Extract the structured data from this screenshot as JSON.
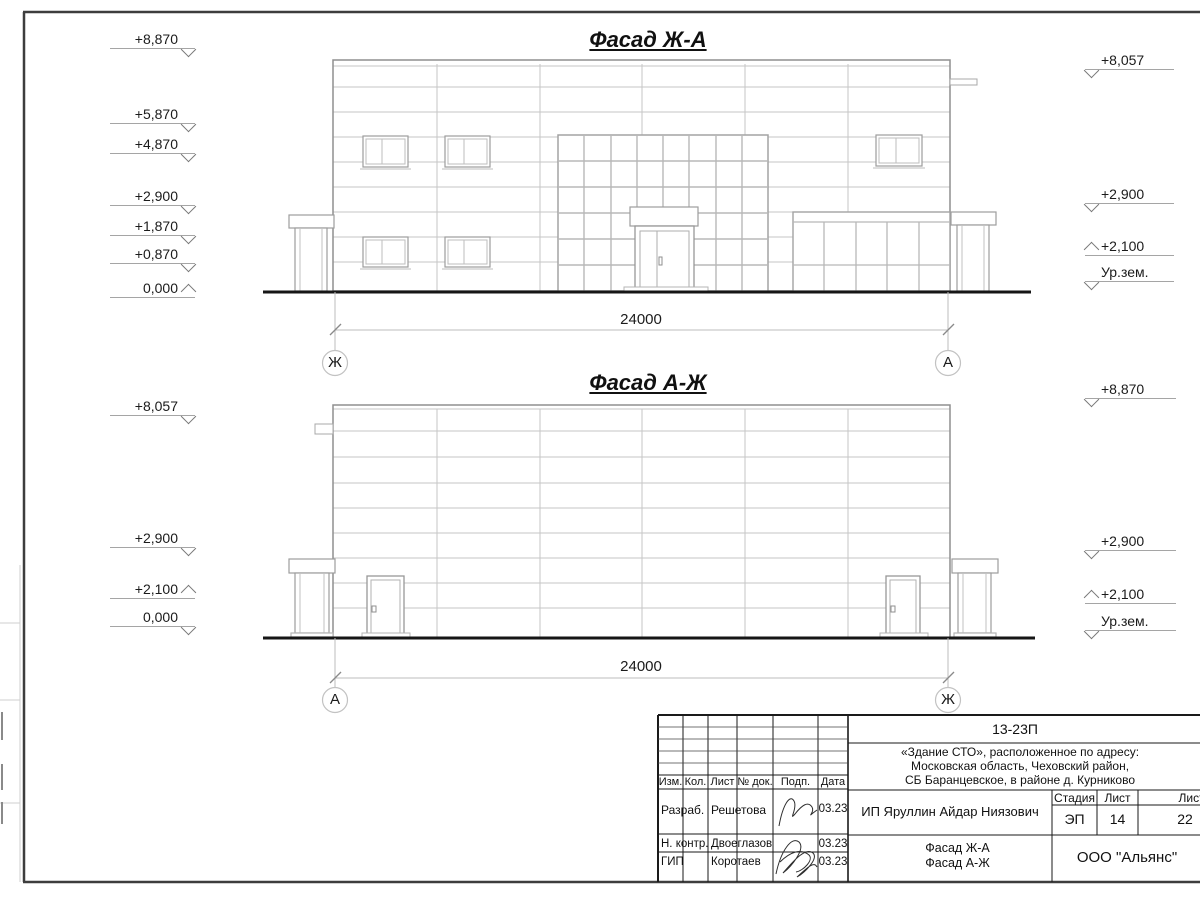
{
  "facade1": {
    "title": "Фасад Ж-А",
    "dimension": "24000",
    "axis_left": "Ж",
    "axis_right": "А",
    "elev_left": [
      {
        "value": "+8,870"
      },
      {
        "value": "+5,870"
      },
      {
        "value": "+4,870"
      },
      {
        "value": "+2,900"
      },
      {
        "value": "+1,870"
      },
      {
        "value": "+0,870"
      },
      {
        "value": "0,000"
      }
    ],
    "elev_right": [
      {
        "value": "+8,057"
      },
      {
        "value": "+2,900"
      },
      {
        "value": "+2,100"
      },
      {
        "value": "Ур.зем."
      }
    ]
  },
  "facade2": {
    "title": "Фасад А-Ж",
    "dimension": "24000",
    "axis_left": "А",
    "axis_right": "Ж",
    "elev_left": [
      {
        "value": "+8,057"
      },
      {
        "value": "+2,900"
      },
      {
        "value": "+2,100"
      },
      {
        "value": "0,000"
      }
    ],
    "elev_right": [
      {
        "value": "+8,870"
      },
      {
        "value": "+2,900"
      },
      {
        "value": "+2,100"
      },
      {
        "value": "Ур.зем."
      }
    ]
  },
  "titleblock": {
    "doc_number": "13-23П",
    "address_line1": "«Здание СТО», расположенное по адресу:",
    "address_line2": "Московская область, Чеховский район,",
    "address_line3": "СБ Баранцевское, в районе д. Курниково",
    "columns": {
      "izm": "Изм.",
      "kol": "Кол.",
      "list": "Лист",
      "doc": "№ док.",
      "podp": "Подп.",
      "data": "Дата"
    },
    "rows": [
      {
        "role": "Разраб.",
        "name": "Решетова",
        "date": "03.23"
      },
      {
        "role": "Н. контр.",
        "name": "Двоеглазов",
        "date": "03.23"
      },
      {
        "role": "ГИП",
        "name": "Коротаев",
        "date": "03.23"
      }
    ],
    "client": "ИП Яруллин Айдар Ниязович",
    "stage_label": "Стадия",
    "sheet_label": "Лист",
    "sheets_label": "Листов",
    "stage": "ЭП",
    "sheet_no": "14",
    "sheets_total": "22",
    "drawing_name1": "Фасад Ж-А",
    "drawing_name2": "Фасад А-Ж",
    "company": "ООО \"Альянс\""
  }
}
